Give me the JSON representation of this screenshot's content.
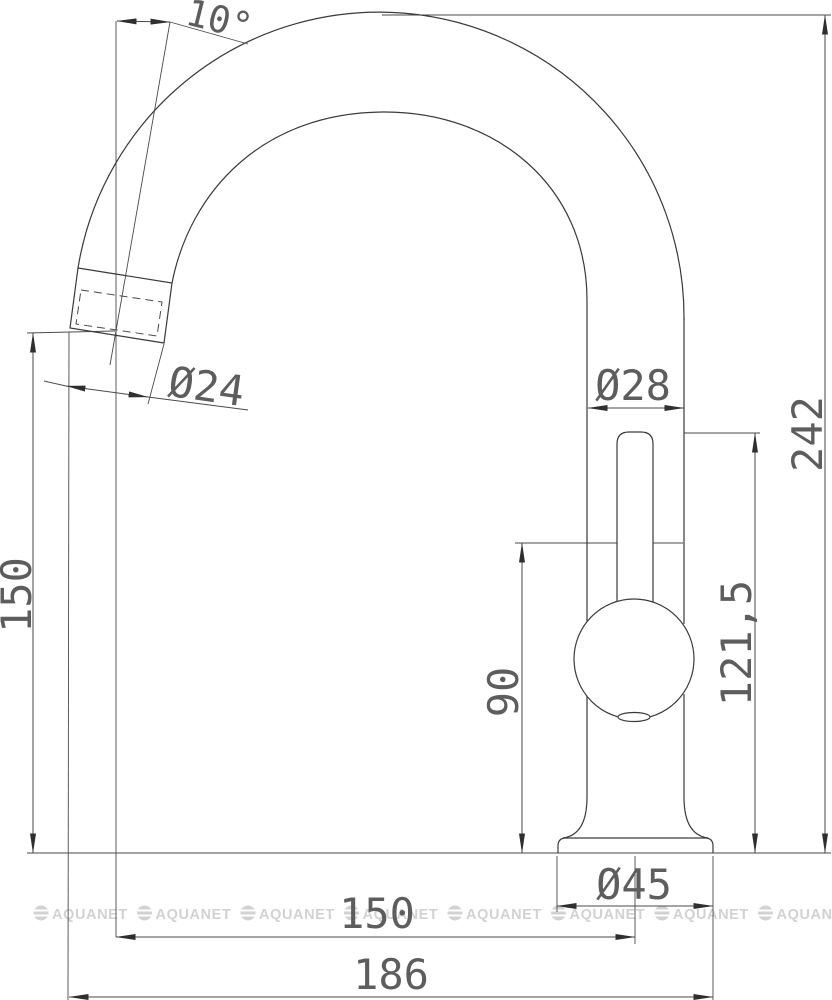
{
  "drawing": {
    "type": "technical-dimension-drawing",
    "subject": "single-lever kitchen faucet, side elevation",
    "dims": {
      "spout_angle": "10°",
      "spout_diameter": "Ø24",
      "body_diameter": "Ø28",
      "overall_height": "242",
      "spout_outlet_height": "150",
      "handle_top_height": "121,5",
      "cartridge_seam_height": "90",
      "base_diameter": "Ø45",
      "reach_to_axis": "150",
      "overall_reach": "186"
    },
    "line_color": "#3a3a3a",
    "dim_color": "#4a4a4a"
  },
  "watermark": {
    "text": "AQUANET",
    "color": "#d2d2d2"
  }
}
